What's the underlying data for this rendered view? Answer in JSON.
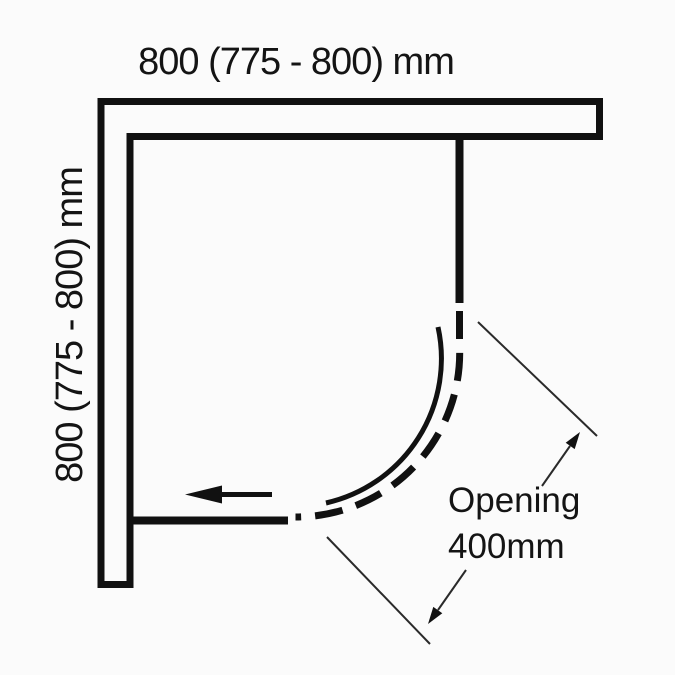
{
  "canvas": {
    "background": "#fbfbfb",
    "line_color": "#111111",
    "thin_line_color": "#2a2a2a"
  },
  "labels": {
    "top_dimension": "800 (775 - 800) mm",
    "side_dimension": "800 (775 - 800) mm",
    "opening_line1": "Opening",
    "opening_line2": "400mm"
  }
}
